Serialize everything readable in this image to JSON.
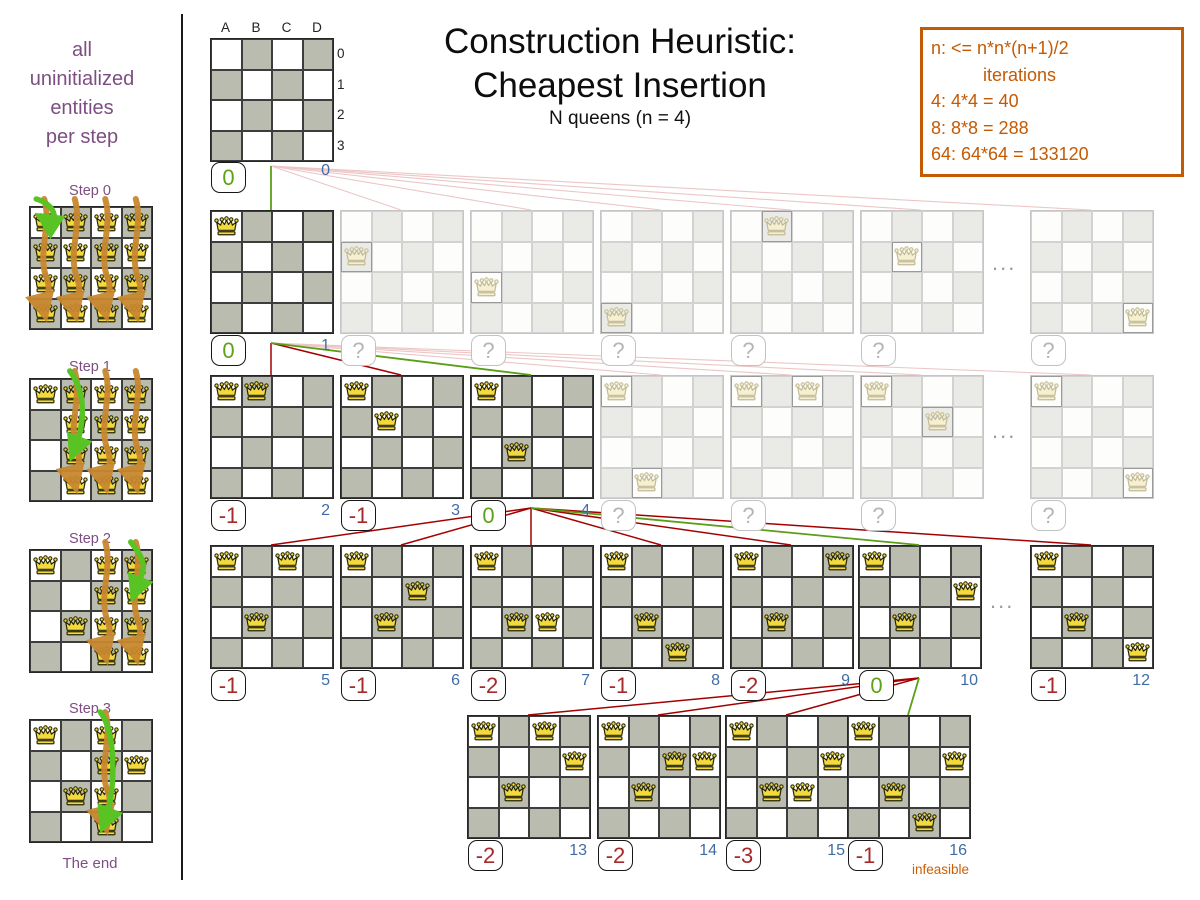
{
  "sidebar": {
    "caption_lines": [
      "all",
      "uninitialized",
      "entities",
      "per step"
    ],
    "steps": [
      {
        "label": "Step 0",
        "label_y": 183,
        "board_y": 206,
        "queens": [
          "A0",
          "A1",
          "A2",
          "A3",
          "B0",
          "B1",
          "B2",
          "B3",
          "C0",
          "C1",
          "C2",
          "C3",
          "D0",
          "D1",
          "D2",
          "D3"
        ],
        "orange_arrow_columns": [
          "A",
          "B",
          "C",
          "D"
        ],
        "green_arrow_target": "A0"
      },
      {
        "label": "Step 1",
        "label_y": 359,
        "board_y": 378,
        "queens": [
          "A0",
          "B0",
          "B1",
          "B2",
          "B3",
          "C0",
          "C1",
          "C2",
          "C3",
          "D0",
          "D1",
          "D2",
          "D3"
        ],
        "orange_arrow_columns": [
          "B",
          "C",
          "D"
        ],
        "green_arrow_target": "B2"
      },
      {
        "label": "Step 2",
        "label_y": 531,
        "board_y": 549,
        "queens": [
          "A0",
          "B2",
          "C0",
          "C1",
          "C2",
          "C3",
          "D0",
          "D1",
          "D2",
          "D3"
        ],
        "orange_arrow_columns": [
          "C",
          "D"
        ],
        "green_arrow_target": "D1"
      },
      {
        "label": "Step 3",
        "label_y": 701,
        "board_y": 719,
        "queens": [
          "A0",
          "B2",
          "D1",
          "C0",
          "C1",
          "C2",
          "C3"
        ],
        "orange_arrow_columns": [
          "C"
        ],
        "green_arrow_target": "C3"
      }
    ],
    "end_label": "The end"
  },
  "header": {
    "title_line1": "Construction Heuristic:",
    "title_line2": "Cheapest Insertion",
    "subtitle": "N queens (n = 4)"
  },
  "info_box": {
    "lines": [
      "n: <= n*n*(n+1)/2",
      "iterations",
      "4: 4*4 = 40",
      "8: 8*8 = 288",
      "64: 64*64 = 133120"
    ]
  },
  "root_board": {
    "x": 210,
    "y": 38,
    "column_headers": [
      "A",
      "B",
      "C",
      "D"
    ],
    "row_headers": [
      "0",
      "1",
      "2",
      "3"
    ],
    "score": "0",
    "index": "0"
  },
  "ellipsis_char": "...",
  "ghost_score_char": "?",
  "tree": {
    "rows": [
      {
        "name": "level-1",
        "y": 210,
        "ellipsis": {
          "x": 992,
          "y": 250
        },
        "boards": [
          {
            "x": 210,
            "queens": [
              "A0"
            ],
            "score": "0",
            "status": "best",
            "index": "1"
          },
          {
            "x": 340,
            "queens": [
              "A1"
            ],
            "score": "?",
            "status": "ghost"
          },
          {
            "x": 470,
            "queens": [
              "A2"
            ],
            "score": "?",
            "status": "ghost"
          },
          {
            "x": 600,
            "queens": [
              "A3"
            ],
            "score": "?",
            "status": "ghost"
          },
          {
            "x": 730,
            "queens": [
              "B0"
            ],
            "score": "?",
            "status": "ghost"
          },
          {
            "x": 860,
            "queens": [
              "B1"
            ],
            "score": "?",
            "status": "ghost"
          },
          {
            "x": 1030,
            "queens": [
              "D3"
            ],
            "score": "?",
            "status": "ghost"
          }
        ]
      },
      {
        "name": "level-2",
        "y": 375,
        "ellipsis": {
          "x": 992,
          "y": 418
        },
        "boards": [
          {
            "x": 210,
            "queens": [
              "A0",
              "B0"
            ],
            "score": "-1",
            "status": "worse",
            "index": "2"
          },
          {
            "x": 340,
            "queens": [
              "A0",
              "B1"
            ],
            "score": "-1",
            "status": "worse",
            "index": "3"
          },
          {
            "x": 470,
            "queens": [
              "A0",
              "B2"
            ],
            "score": "0",
            "status": "best",
            "index": "4"
          },
          {
            "x": 600,
            "queens": [
              "A0",
              "B3"
            ],
            "score": "?",
            "status": "ghost"
          },
          {
            "x": 730,
            "queens": [
              "A0",
              "C0"
            ],
            "score": "?",
            "status": "ghost"
          },
          {
            "x": 860,
            "queens": [
              "A0",
              "C1"
            ],
            "score": "?",
            "status": "ghost"
          },
          {
            "x": 1030,
            "queens": [
              "A0",
              "D3"
            ],
            "score": "?",
            "status": "ghost"
          }
        ]
      },
      {
        "name": "level-3",
        "y": 545,
        "ellipsis": {
          "x": 990,
          "y": 588
        },
        "boards": [
          {
            "x": 210,
            "queens": [
              "A0",
              "B2",
              "C0"
            ],
            "score": "-1",
            "status": "worse",
            "index": "5"
          },
          {
            "x": 340,
            "queens": [
              "A0",
              "B2",
              "C1"
            ],
            "score": "-1",
            "status": "worse",
            "index": "6"
          },
          {
            "x": 470,
            "queens": [
              "A0",
              "B2",
              "C2"
            ],
            "score": "-2",
            "status": "worse",
            "index": "7"
          },
          {
            "x": 600,
            "queens": [
              "A0",
              "B2",
              "C3"
            ],
            "score": "-1",
            "status": "worse",
            "index": "8"
          },
          {
            "x": 730,
            "queens": [
              "A0",
              "B2",
              "D0"
            ],
            "score": "-2",
            "status": "worse",
            "index": "9"
          },
          {
            "x": 858,
            "queens": [
              "A0",
              "B2",
              "D1"
            ],
            "score": "0",
            "status": "best",
            "index": "10"
          },
          {
            "x": 1030,
            "queens": [
              "A0",
              "B2",
              "D3"
            ],
            "score": "-1",
            "status": "worse",
            "index": "12"
          }
        ]
      },
      {
        "name": "level-4",
        "y": 715,
        "boards": [
          {
            "x": 467,
            "queens": [
              "A0",
              "B2",
              "D1",
              "C0"
            ],
            "score": "-2",
            "status": "worse",
            "index": "13"
          },
          {
            "x": 597,
            "queens": [
              "A0",
              "B2",
              "D1",
              "C1"
            ],
            "score": "-2",
            "status": "worse",
            "index": "14"
          },
          {
            "x": 725,
            "queens": [
              "A0",
              "B2",
              "D1",
              "C2"
            ],
            "score": "-3",
            "status": "worse",
            "index": "15"
          },
          {
            "x": 847,
            "queens": [
              "A0",
              "B2",
              "D1",
              "C3"
            ],
            "score": "-1",
            "status": "worse",
            "index": "16",
            "note": "infeasible"
          }
        ]
      }
    ],
    "edges": [
      {
        "from": "root",
        "to": "0.0",
        "kind": "selected"
      },
      {
        "from": "root",
        "to": "0.1",
        "kind": "ghost"
      },
      {
        "from": "root",
        "to": "0.2",
        "kind": "ghost"
      },
      {
        "from": "root",
        "to": "0.3",
        "kind": "ghost"
      },
      {
        "from": "root",
        "to": "0.4",
        "kind": "ghost"
      },
      {
        "from": "root",
        "to": "0.5",
        "kind": "ghost"
      },
      {
        "from": "root",
        "to": "0.6",
        "kind": "ghost"
      },
      {
        "from": "0.0",
        "to": "1.0",
        "kind": "evaluated"
      },
      {
        "from": "0.0",
        "to": "1.1",
        "kind": "evaluated"
      },
      {
        "from": "0.0",
        "to": "1.2",
        "kind": "selected"
      },
      {
        "from": "0.0",
        "to": "1.3",
        "kind": "ghost"
      },
      {
        "from": "0.0",
        "to": "1.4",
        "kind": "ghost"
      },
      {
        "from": "0.0",
        "to": "1.5",
        "kind": "ghost"
      },
      {
        "from": "0.0",
        "to": "1.6",
        "kind": "ghost"
      },
      {
        "from": "1.2",
        "to": "2.0",
        "kind": "evaluated"
      },
      {
        "from": "1.2",
        "to": "2.1",
        "kind": "evaluated"
      },
      {
        "from": "1.2",
        "to": "2.2",
        "kind": "evaluated"
      },
      {
        "from": "1.2",
        "to": "2.3",
        "kind": "evaluated"
      },
      {
        "from": "1.2",
        "to": "2.4",
        "kind": "evaluated"
      },
      {
        "from": "1.2",
        "to": "2.5",
        "kind": "selected"
      },
      {
        "from": "1.2",
        "to": "2.6",
        "kind": "evaluated"
      },
      {
        "from": "2.5",
        "to": "3.0",
        "kind": "evaluated"
      },
      {
        "from": "2.5",
        "to": "3.1",
        "kind": "evaluated"
      },
      {
        "from": "2.5",
        "to": "3.2",
        "kind": "evaluated"
      },
      {
        "from": "2.5",
        "to": "3.3",
        "kind": "selected"
      }
    ]
  }
}
